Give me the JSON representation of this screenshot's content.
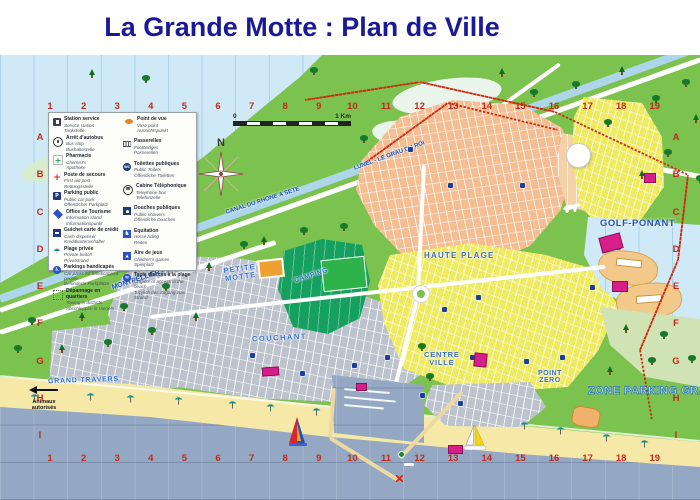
{
  "title": "La Grande Motte : Plan de Ville",
  "legend": {
    "left": [
      {
        "icon": "fuel",
        "fr": "Station service",
        "en": "Service station",
        "de": "Tankstelle"
      },
      {
        "icon": "bus",
        "fr": "Arrêt d'autobus",
        "en": "Bus stop",
        "de": "Bushaltestelle"
      },
      {
        "icon": "pharmacy",
        "fr": "Pharmacie",
        "en": "Chemist's",
        "de": "Apotheke"
      },
      {
        "icon": "firstaid",
        "fr": "Poste de secours",
        "en": "First aid post",
        "de": "Rettungsstelle"
      },
      {
        "icon": "parking",
        "fr": "Parking public",
        "en": "Public car park",
        "de": "Öffentlicher Parkplatz"
      },
      {
        "icon": "tourisme",
        "fr": "Office de Tourisme",
        "en": "Information stand",
        "de": "Informationspunkt"
      },
      {
        "icon": "credit",
        "fr": "Guichet carte de crédit",
        "en": "Cash dispenser",
        "de": "Kreditkartenschalter"
      },
      {
        "icon": "beach",
        "fr": "Plage privée",
        "en": "Private beach",
        "de": "Privatstrand"
      },
      {
        "icon": "handicap",
        "fr": "Parkings handicapés",
        "en": "Car parks for handicapped people",
        "de": "Behinderte Parkplätze"
      },
      {
        "icon": "depannage",
        "fr": "Dépannage en quartiers",
        "en": "Towing in districts",
        "de": "Abschleppen in Vierteln"
      }
    ],
    "right": [
      {
        "icon": "viewpoint",
        "fr": "Point de vue",
        "en": "View point",
        "de": "Aussichtspunkt"
      },
      {
        "icon": "passerelle",
        "fr": "Passerelles",
        "en": "Footbridges",
        "de": "Passerellen"
      },
      {
        "icon": "wc",
        "fr": "Toilettes publiques",
        "en": "Public Toilets",
        "de": "Öffentliche Toiletten"
      },
      {
        "icon": "phone",
        "fr": "Cabine Téléphonique",
        "en": "Telephone box",
        "de": "Telefonzelle"
      },
      {
        "icon": "shower",
        "fr": "Douches publiques",
        "en": "Public showers",
        "de": "Öffentliche Duschen"
      },
      {
        "icon": "horse",
        "fr": "Equitation",
        "en": "Horse riding",
        "de": "Reiten"
      },
      {
        "icon": "games",
        "fr": "Aire de jeux",
        "en": "Children's games",
        "de": "Spielplatz"
      },
      {
        "icon": "tapis",
        "fr": "Tapis d'accès à la plage",
        "en": "Carpets of access to the beach",
        "de": "Teppich des Zugang zum Strand"
      }
    ]
  },
  "grid": {
    "columns": [
      "1",
      "2",
      "3",
      "4",
      "5",
      "6",
      "7",
      "8",
      "9",
      "10",
      "11",
      "12",
      "13",
      "14",
      "15",
      "16",
      "17",
      "18",
      "19"
    ],
    "rows": [
      "A",
      "B",
      "C",
      "D",
      "E",
      "F",
      "G",
      "H",
      "I"
    ]
  },
  "labels": {
    "petite_motte": "PETITE\nMOTTE",
    "haute_plage": "HAUTE PLAGE",
    "couchant": "COUCHANT",
    "camping": "CAMPING",
    "centre_ville": "CENTRE\nVILLE",
    "point_zero": "POINT\nZERO",
    "golf_ponant": "GOLF-PONANT",
    "grand_travers": "GRAND TRAVERS",
    "zone_parking": "ZONE PARKING GRATUIT",
    "animaux": "Animaux\nautorisés",
    "north": "N",
    "scale_zero": "0",
    "scale_km": "1 Km"
  },
  "roads": {
    "montpellier": "MONTPELLIER - CARNON",
    "canal": "CANAL DU RHONE A SETE",
    "lunel": "LUNEL - LE GRAU DU ROI"
  },
  "colors": {
    "title": "#1a1a99",
    "grid_label": "#c4291c",
    "map_label_blue": "#3a6fd0",
    "sea_light": "#cfe9f7",
    "sea_deep": "#94a8c4",
    "land_green": "#7cc24e",
    "sand": "#f6e9a8",
    "district_salmon": "#f5bd92",
    "district_yellow": "#f0ea5e",
    "district_gray": "#bcc3cd",
    "camping_green": "#16a05f",
    "magenta": "#d61f8b"
  }
}
